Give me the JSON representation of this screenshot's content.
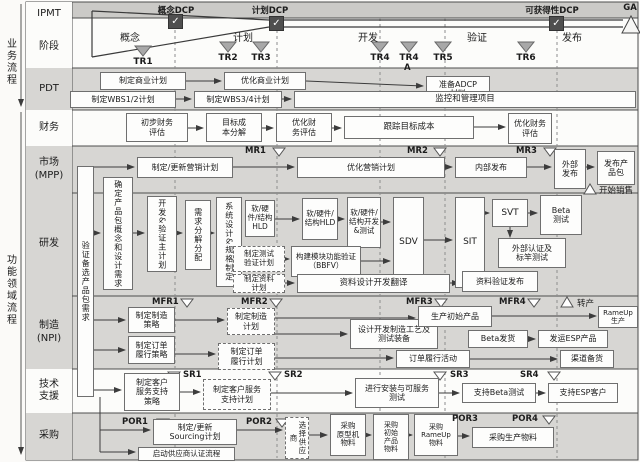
{
  "rail": {
    "business": "业务流程",
    "functional": "功能领域流程"
  },
  "top": {
    "dcps": [
      {
        "id": "concept-dcp",
        "label": "概念DCP",
        "cx": 176,
        "sq_x": 168,
        "sq_y": 14
      },
      {
        "id": "plan-dcp",
        "label": "计划DCP",
        "cx": 270,
        "sq_x": 269,
        "sq_y": 16
      },
      {
        "id": "availability-dcp",
        "label": "可获得性DCP",
        "cx": 552,
        "sq_x": 549,
        "sq_y": 16
      }
    ],
    "ga_label": "GA",
    "check_glyph": "✓"
  },
  "phases": [
    {
      "label": "概念",
      "cx": 130
    },
    {
      "label": "计划",
      "cx": 243
    },
    {
      "label": "开发",
      "cx": 368
    },
    {
      "label": "验证",
      "cx": 477
    },
    {
      "label": "发布",
      "cx": 572
    }
  ],
  "tr_markers": [
    {
      "label": "TR1",
      "cx": 143,
      "ty": 46
    },
    {
      "label": "TR2",
      "cx": 228,
      "ty": 42
    },
    {
      "label": "TR3",
      "cx": 261,
      "ty": 42
    },
    {
      "label": "TR4",
      "cx": 380,
      "ty": 42
    },
    {
      "label": "TR4",
      "cx": 409,
      "ty": 42
    },
    {
      "label": "TR5",
      "cx": 443,
      "ty": 42
    },
    {
      "label": "TR6",
      "cx": 526,
      "ty": 42
    }
  ],
  "lanes": [
    {
      "id": "ipmt",
      "label": "IPMT",
      "y": 2,
      "h": 24,
      "bg": "#fcfcfa"
    },
    {
      "id": "stage",
      "label": "阶段",
      "y": 26,
      "h": 42,
      "bg": "#fcfcfa"
    },
    {
      "id": "pdt",
      "label": "PDT",
      "y": 68,
      "h": 42,
      "bg": "#d7d6d3"
    },
    {
      "id": "finance",
      "label": "财务",
      "y": 110,
      "h": 36,
      "bg": "#fcfcfa"
    },
    {
      "id": "market",
      "label": "市场\n(MPP)",
      "y": 146,
      "h": 47,
      "bg": "#d7d6d3"
    },
    {
      "id": "rnd",
      "label": "研发",
      "y": 193,
      "h": 103,
      "bg": "#d7d6d3"
    },
    {
      "id": "mfg",
      "label": "制造\n(NPI)",
      "y": 296,
      "h": 73,
      "bg": "#d7d6d3"
    },
    {
      "id": "support",
      "label": "技术\n支援",
      "y": 369,
      "h": 44,
      "bg": "#fcfcfa"
    },
    {
      "id": "procure",
      "label": "采购",
      "y": 413,
      "h": 47,
      "bg": "#d7d6d3"
    }
  ],
  "nodes": [
    {
      "id": "develop-business-plan",
      "label": "制定商业计划",
      "x": 100,
      "y": 72,
      "w": 86,
      "h": 18
    },
    {
      "id": "optimize-business-plan",
      "label": "优化商业计划",
      "x": 224,
      "y": 72,
      "w": 82,
      "h": 18
    },
    {
      "id": "prepare-adcp-material",
      "label": "准备ADCP\n材料",
      "x": 426,
      "y": 76,
      "w": 64,
      "h": 26
    },
    {
      "id": "develop-wbs12-plan",
      "label": "制定WBS1/2计划",
      "x": 70,
      "y": 91,
      "w": 106,
      "h": 17
    },
    {
      "id": "develop-wbs34-plan",
      "label": "制定WBS3/4计划",
      "x": 194,
      "y": 91,
      "w": 88,
      "h": 17
    },
    {
      "id": "monitor-manage-project",
      "label": "监控和管理项目",
      "x": 294,
      "y": 91,
      "w": 342,
      "h": 17,
      "fs": 8.5
    },
    {
      "id": "initial-financial-eval",
      "label": "初步财务\n评估",
      "x": 126,
      "y": 113,
      "w": 62,
      "h": 29
    },
    {
      "id": "target-cost-breakdown",
      "label": "目标成\n本分解",
      "x": 206,
      "y": 113,
      "w": 56,
      "h": 29
    },
    {
      "id": "optimize-financial-eval-1",
      "label": "优化财\n务评估",
      "x": 276,
      "y": 113,
      "w": 56,
      "h": 29
    },
    {
      "id": "track-target-cost",
      "label": "跟踪目标成本",
      "x": 344,
      "y": 116,
      "w": 130,
      "h": 23,
      "fs": 8.5
    },
    {
      "id": "optimize-financial-eval-2",
      "label": "优化财务\n评估",
      "x": 508,
      "y": 113,
      "w": 44,
      "h": 31
    },
    {
      "id": "verify-candidate-pkg-req",
      "label": "验证备选产品包需求",
      "x": 77,
      "y": 166,
      "w": 17,
      "h": 231,
      "v": 1
    },
    {
      "id": "make-update-marketing-plan",
      "label": "制定/更新营销计划",
      "x": 137,
      "y": 157,
      "w": 96,
      "h": 21
    },
    {
      "id": "optimize-marketing-plan",
      "label": "优化营销计划",
      "x": 297,
      "y": 157,
      "w": 148,
      "h": 21
    },
    {
      "id": "internal-release",
      "label": "内部发布",
      "x": 455,
      "y": 157,
      "w": 72,
      "h": 21
    },
    {
      "id": "external-release",
      "label": "外部\n发布",
      "x": 554,
      "y": 149,
      "w": 32,
      "h": 40
    },
    {
      "id": "release-product-package",
      "label": "发布产\n品包",
      "x": 597,
      "y": 151,
      "w": 38,
      "h": 34
    },
    {
      "id": "define-pkg-concept-design-req",
      "label": "确定产品包概念和设计需求",
      "x": 103,
      "y": 177,
      "w": 30,
      "h": 113,
      "v": 1
    },
    {
      "id": "dev-verify-master-plan",
      "label": "开发&验证主计划",
      "x": 147,
      "y": 196,
      "w": 30,
      "h": 76,
      "v": 1
    },
    {
      "id": "requirement-decompose-allocate",
      "label": "需求分解分配",
      "x": 185,
      "y": 200,
      "w": 26,
      "h": 70,
      "v": 1
    },
    {
      "id": "system-design-spec",
      "label": "系统设计&规格制定",
      "x": 216,
      "y": 197,
      "w": 26,
      "h": 90,
      "v": 1
    },
    {
      "id": "sw-hw-structure-hld-1",
      "label": "软/硬件/结构HLD",
      "x": 245,
      "y": 200,
      "w": 30,
      "h": 37,
      "fs": 7.5
    },
    {
      "id": "sw-hw-structure-hld-2",
      "label": "软/硬件/结构HLD",
      "x": 302,
      "y": 198,
      "w": 36,
      "h": 42,
      "fs": 7.5
    },
    {
      "id": "sw-hw-structure-dev-test",
      "label": "软/硬件/结构开发&测试",
      "x": 347,
      "y": 197,
      "w": 34,
      "h": 51,
      "fs": 7.5
    },
    {
      "id": "sdv",
      "label": "SDV",
      "x": 393,
      "y": 197,
      "w": 31,
      "h": 91,
      "fs": 9
    },
    {
      "id": "sit",
      "label": "SIT",
      "x": 455,
      "y": 197,
      "w": 30,
      "h": 91,
      "fs": 9
    },
    {
      "id": "svt",
      "label": "SVT",
      "x": 492,
      "y": 199,
      "w": 36,
      "h": 28,
      "fs": 9
    },
    {
      "id": "beta-test",
      "label": "Beta\n测试",
      "x": 540,
      "y": 195,
      "w": 42,
      "h": 40
    },
    {
      "id": "external-cert-benchmark-test",
      "label": "外部认证及\n标竿测试",
      "x": 498,
      "y": 238,
      "w": 68,
      "h": 30
    },
    {
      "id": "doc-verify-release",
      "label": "资料验证发布",
      "x": 462,
      "y": 271,
      "w": 76,
      "h": 21
    },
    {
      "id": "make-test-verify-plan",
      "label": "制定测试\n验证计划",
      "x": 233,
      "y": 246,
      "w": 52,
      "h": 26,
      "dash": 1,
      "fs": 7.5
    },
    {
      "id": "make-doc-plan",
      "label": "制定资料\n计划",
      "x": 233,
      "y": 274,
      "w": 52,
      "h": 19,
      "dash": 1,
      "fs": 7.5
    },
    {
      "id": "bbfv",
      "label": "构建模块功能验证\n（BBFV）",
      "x": 291,
      "y": 246,
      "w": 70,
      "h": 31,
      "fs": 7.5
    },
    {
      "id": "doc-design-dev-translate",
      "label": "资料设计开发翻译",
      "x": 297,
      "y": 274,
      "w": 153,
      "h": 19,
      "fs": 8.5
    },
    {
      "id": "make-mfg-strategy",
      "label": "制定制造\n策略",
      "x": 128,
      "y": 307,
      "w": 47,
      "h": 26
    },
    {
      "id": "make-order-fulfill-strategy",
      "label": "制定订单\n履行策略",
      "x": 128,
      "y": 336,
      "w": 47,
      "h": 28
    },
    {
      "id": "make-mfg-plan",
      "label": "制定制造\n计划",
      "x": 227,
      "y": 308,
      "w": 48,
      "h": 27,
      "dash": 1
    },
    {
      "id": "make-order-fulfill-plan",
      "label": "制定订单\n履行计划",
      "x": 218,
      "y": 343,
      "w": 57,
      "h": 27,
      "dash": 1
    },
    {
      "id": "design-mfg-process-equipment",
      "label": "设计开发制造工艺及\n测试装备",
      "x": 350,
      "y": 319,
      "w": 88,
      "h": 30
    },
    {
      "id": "produce-initial-product",
      "label": "生产初始产品",
      "x": 418,
      "y": 306,
      "w": 74,
      "h": 21
    },
    {
      "id": "rampup-production",
      "label": "RameUp生产",
      "x": 598,
      "y": 306,
      "w": 40,
      "h": 22,
      "fs": 7
    },
    {
      "id": "beta-shipment",
      "label": "Beta发货",
      "x": 468,
      "y": 330,
      "w": 60,
      "h": 18
    },
    {
      "id": "ship-esp-product",
      "label": "发运ESP产品",
      "x": 538,
      "y": 330,
      "w": 70,
      "h": 18
    },
    {
      "id": "order-fulfill-activity",
      "label": "订单履行活动",
      "x": 396,
      "y": 350,
      "w": 74,
      "h": 18
    },
    {
      "id": "channel-stocking",
      "label": "渠道备货",
      "x": 560,
      "y": 350,
      "w": 54,
      "h": 18
    },
    {
      "id": "make-service-support-strategy",
      "label": "制定客户\n服务支持\n策略",
      "x": 124,
      "y": 373,
      "w": 56,
      "h": 38
    },
    {
      "id": "make-service-support-plan",
      "label": "制定客户服务\n支持计划",
      "x": 203,
      "y": 379,
      "w": 68,
      "h": 31,
      "dash": 1
    },
    {
      "id": "install-serviceability-test",
      "label": "进行安装与可服务\n测试",
      "x": 355,
      "y": 378,
      "w": 84,
      "h": 30
    },
    {
      "id": "support-beta-test",
      "label": "支持Beta测试",
      "x": 462,
      "y": 383,
      "w": 74,
      "h": 20
    },
    {
      "id": "support-esp-customer",
      "label": "支持ESP客户",
      "x": 548,
      "y": 383,
      "w": 70,
      "h": 20
    },
    {
      "id": "make-update-sourcing-plan",
      "label": "制定/更新\nSourcing计划",
      "x": 153,
      "y": 419,
      "w": 84,
      "h": 26
    },
    {
      "id": "start-supplier-cert-process",
      "label": "启动供应商认证流程",
      "x": 138,
      "y": 447,
      "w": 97,
      "h": 14,
      "fs": 7.5
    },
    {
      "id": "select-supplier",
      "label": "选择供应商",
      "x": 285,
      "y": 417,
      "w": 24,
      "h": 42,
      "v": 1,
      "dash": 1,
      "fs": 7.5
    },
    {
      "id": "buy-prototype-material",
      "label": "采购\n原型机\n物料",
      "x": 330,
      "y": 414,
      "w": 36,
      "h": 42,
      "fs": 7.5
    },
    {
      "id": "buy-initial-product-material",
      "label": "采购\n初始\n产品\n物料",
      "x": 373,
      "y": 414,
      "w": 36,
      "h": 46,
      "fs": 7
    },
    {
      "id": "buy-rampup-material",
      "label": "采购\nRameUp\n物料",
      "x": 414,
      "y": 414,
      "w": 44,
      "h": 42,
      "fs": 7
    },
    {
      "id": "buy-production-material",
      "label": "采购生产物料",
      "x": 472,
      "y": 427,
      "w": 82,
      "h": 21
    }
  ],
  "review_markers": [
    {
      "label": "MR1",
      "x": 245,
      "y": 146,
      "tx": 273
    },
    {
      "label": "MR2",
      "x": 407,
      "y": 146,
      "tx": 434
    },
    {
      "label": "MR3",
      "x": 516,
      "y": 146,
      "tx": 544
    },
    {
      "label": "MFR1",
      "x": 152,
      "y": 297,
      "tx": 181
    },
    {
      "label": "MFR2",
      "x": 241,
      "y": 297,
      "tx": 270
    },
    {
      "label": "MFR3",
      "x": 406,
      "y": 297,
      "tx": 435
    },
    {
      "label": "MFR4",
      "x": 499,
      "y": 297,
      "tx": 528
    },
    {
      "label": "SR1",
      "x": 183,
      "y": 370,
      "tx": 168
    },
    {
      "label": "SR2",
      "x": 284,
      "y": 370,
      "tx": 269
    },
    {
      "label": "SR3",
      "x": 450,
      "y": 370,
      "tx": 434
    },
    {
      "label": "SR4",
      "x": 520,
      "y": 370,
      "tx": 548
    },
    {
      "label": "POR1",
      "x": 122,
      "y": 417,
      "tx": 157
    },
    {
      "label": "POR2",
      "x": 246,
      "y": 417,
      "tx": 276
    },
    {
      "label": "POR3",
      "x": 452,
      "y": 414,
      "tx": 437
    },
    {
      "label": "POR4",
      "x": 512,
      "y": 414,
      "tx": 543
    }
  ],
  "annotations": [
    {
      "id": "tr4a-suffix",
      "label": "A",
      "x": 404,
      "y": 63,
      "bold": true
    },
    {
      "id": "start-sales",
      "label": "开始销售",
      "x": 599,
      "y": 184,
      "tri": [
        584,
        194,
        596,
        194,
        590,
        184
      ]
    },
    {
      "id": "transfer-production",
      "label": "转产",
      "x": 577,
      "y": 297,
      "tri": [
        561,
        307,
        573,
        307,
        567,
        297
      ]
    }
  ],
  "geometry": {
    "dashed_lines_x": [
      175,
      277,
      380,
      445,
      557
    ],
    "funnel_lines": [
      [
        92,
        11,
        269,
        20
      ],
      [
        269,
        20,
        623,
        20
      ],
      [
        92,
        57,
        269,
        27
      ],
      [
        269,
        27,
        623,
        27
      ],
      [
        92,
        11,
        92,
        57
      ]
    ],
    "plain_lines": [
      [
        100,
        397,
        100,
        452
      ],
      [
        510,
        227,
        510,
        232
      ]
    ],
    "arrows": [
      [
        186,
        81,
        221,
        81
      ],
      [
        306,
        81,
        423,
        86
      ],
      [
        176,
        99,
        191,
        99
      ],
      [
        282,
        99,
        291,
        99
      ],
      [
        188,
        128,
        203,
        128
      ],
      [
        262,
        128,
        273,
        128
      ],
      [
        332,
        128,
        341,
        128
      ],
      [
        474,
        127,
        505,
        127
      ],
      [
        94,
        167,
        134,
        167
      ],
      [
        233,
        167,
        294,
        167
      ],
      [
        445,
        167,
        452,
        167
      ],
      [
        527,
        167,
        551,
        167
      ],
      [
        586,
        167,
        594,
        167
      ],
      [
        94,
        233,
        100,
        233
      ],
      [
        133,
        233,
        144,
        233
      ],
      [
        177,
        233,
        182,
        233
      ],
      [
        210,
        233,
        214,
        233
      ],
      [
        275,
        219,
        299,
        219
      ],
      [
        338,
        219,
        344,
        219
      ],
      [
        381,
        222,
        390,
        222
      ],
      [
        424,
        240,
        452,
        240
      ],
      [
        485,
        213,
        489,
        213
      ],
      [
        528,
        213,
        537,
        213
      ],
      [
        510,
        232,
        510,
        237
      ],
      [
        285,
        259,
        289,
        259
      ],
      [
        361,
        261,
        390,
        261
      ],
      [
        285,
        283,
        294,
        283
      ],
      [
        450,
        283,
        459,
        283
      ],
      [
        94,
        320,
        125,
        320
      ],
      [
        94,
        350,
        125,
        350
      ],
      [
        175,
        320,
        224,
        320
      ],
      [
        175,
        354,
        215,
        354
      ],
      [
        275,
        318,
        415,
        318
      ],
      [
        275,
        334,
        347,
        334
      ],
      [
        275,
        358,
        393,
        358
      ],
      [
        492,
        316,
        596,
        316
      ],
      [
        528,
        339,
        535,
        339
      ],
      [
        470,
        359,
        557,
        359
      ],
      [
        94,
        390,
        121,
        390
      ],
      [
        180,
        392,
        200,
        392
      ],
      [
        271,
        393,
        352,
        393
      ],
      [
        439,
        393,
        459,
        393
      ],
      [
        536,
        393,
        545,
        393
      ],
      [
        100,
        430,
        150,
        430
      ],
      [
        100,
        452,
        135,
        452
      ],
      [
        237,
        430,
        282,
        430
      ],
      [
        309,
        435,
        327,
        435
      ],
      [
        366,
        435,
        371,
        435
      ],
      [
        409,
        435,
        412,
        435
      ],
      [
        458,
        436,
        469,
        436
      ]
    ],
    "borders": [
      [
        26,
        68,
        638,
        68
      ],
      [
        26,
        110,
        638,
        110
      ],
      [
        26,
        146,
        638,
        146
      ],
      [
        26,
        193,
        638,
        193
      ],
      [
        26,
        296,
        638,
        296
      ],
      [
        26,
        369,
        638,
        369
      ],
      [
        26,
        413,
        638,
        413
      ],
      [
        26,
        26,
        72,
        26
      ],
      [
        72,
        18,
        638,
        18
      ]
    ]
  },
  "colors": {
    "lane_gray": "#d7d6d3",
    "lane_white": "#fcfcfa",
    "strip_gray": "#cbcac7",
    "border_dark": "#4e4e4e",
    "box_border": "#6f6f6f",
    "tr_fill": "#a8a8a8",
    "arrow": "#3c3c3c",
    "dcp_square": "#4f4f4f"
  }
}
